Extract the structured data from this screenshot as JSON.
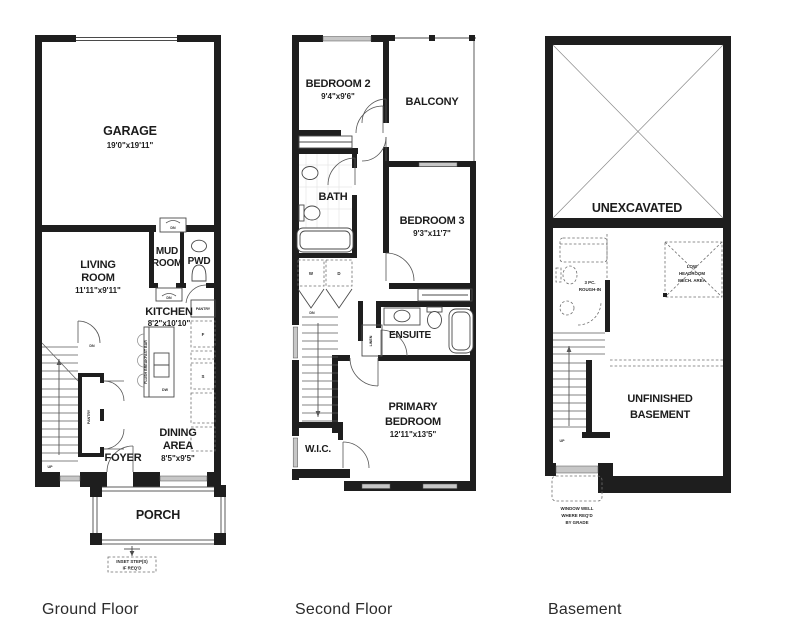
{
  "captions": {
    "ground": "Ground Floor",
    "second": "Second Floor",
    "basement": "Basement"
  },
  "ground": {
    "garage_name": "GARAGE",
    "garage_dims": "19'0\"x19'11\"",
    "living_1": "LIVING",
    "living_2": "ROOM",
    "living_dims": "11'11\"x9'11\"",
    "mud_1": "MUD",
    "mud_2": "ROOM",
    "pwd": "PWD",
    "kitchen": "KITCHEN",
    "kitchen_dims": "8'2\"x10'10\"",
    "dining_1": "DINING",
    "dining_2": "AREA",
    "dining_dims": "8'5\"x9'5\"",
    "foyer": "FOYER",
    "porch": "PORCH",
    "pantry_closet": "PANTRY",
    "pantry_cabinet": "PANTRY",
    "flush_bar": "FLUSH BREAKFAST BAR",
    "dn_top": "DN",
    "dn_mid": "DN",
    "dn_stairs": "DN",
    "up": "UP",
    "dw": "DW",
    "fridge": "F",
    "stove": "S",
    "inset_1": "INSET STEP(S)",
    "inset_2": "IF REQ'D"
  },
  "second": {
    "bedroom2": "BEDROOM 2",
    "bedroom2_dims": "9'4\"x9'6\"",
    "balcony": "BALCONY",
    "bath": "BATH",
    "bedroom3": "BEDROOM 3",
    "bedroom3_dims": "9'3\"x11'7\"",
    "ensuite": "ENSUITE",
    "linen": "LINEN",
    "primary_1": "PRIMARY",
    "primary_2": "BEDROOM",
    "primary_dims": "12'11\"x13'5\"",
    "wic": "W.I.C.",
    "dn": "DN",
    "washer": "W",
    "dryer": "D"
  },
  "basement": {
    "unexcavated": "UNEXCAVATED",
    "rough_1": "3 PC.",
    "rough_2": "ROUGH-IN",
    "low_1": "LOW",
    "low_2": "HEADROOM",
    "low_3": "MECH. AREA",
    "unfinished_1": "UNFINISHED",
    "unfinished_2": "BASEMENT",
    "up": "UP",
    "well_1": "WINDOW WELL",
    "well_2": "WHERE REQ'D",
    "well_3": "BY GRADE"
  }
}
